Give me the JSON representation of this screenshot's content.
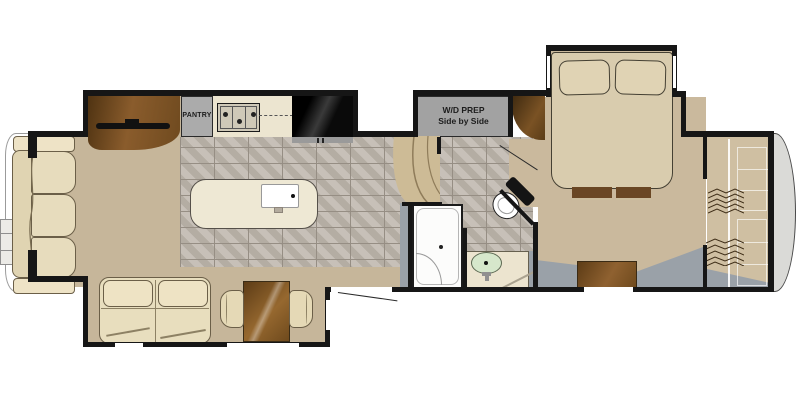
{
  "floorplan": {
    "type": "rv-fifth-wheel-floor-plan",
    "labels": {
      "pantry": "PANTRY",
      "wd_line1": "W/D PREP",
      "wd_line2": "Side by Side"
    },
    "rooms": [
      "living-area",
      "kitchen",
      "hallway",
      "bathroom",
      "bedroom",
      "front-closet"
    ],
    "fixtures": [
      "rear-sofa",
      "entertainment-center",
      "tv",
      "pantry",
      "cooktop",
      "refrigerator",
      "kitchen-island",
      "island-sink",
      "theater-seating",
      "dining-table",
      "dining-chairs",
      "entry-door",
      "curved-steps",
      "bedroom-door",
      "shower",
      "toilet",
      "vanity-sink",
      "wd-prep-cabinet",
      "wardrobe",
      "queen-bed",
      "pillows",
      "foot-cabinets",
      "dresser",
      "closet-rod",
      "hangers",
      "closet-shelves",
      "front-cap",
      "rear-cap"
    ],
    "colors": {
      "wall": "#161616",
      "carpet_tan": "#c6b69a",
      "bedroom_tan": "#cab99d",
      "tile_gray": "#beb6ac",
      "tile_grout": "#968e84",
      "counter_cream": "#ece5d0",
      "appliance_gray": "#a2a2a2",
      "furniture_brown": "#8f6130",
      "sofa_cream": "#e7dcbd",
      "sink_green": "#d6e7cb",
      "cap_gray": "#dadad7"
    }
  }
}
